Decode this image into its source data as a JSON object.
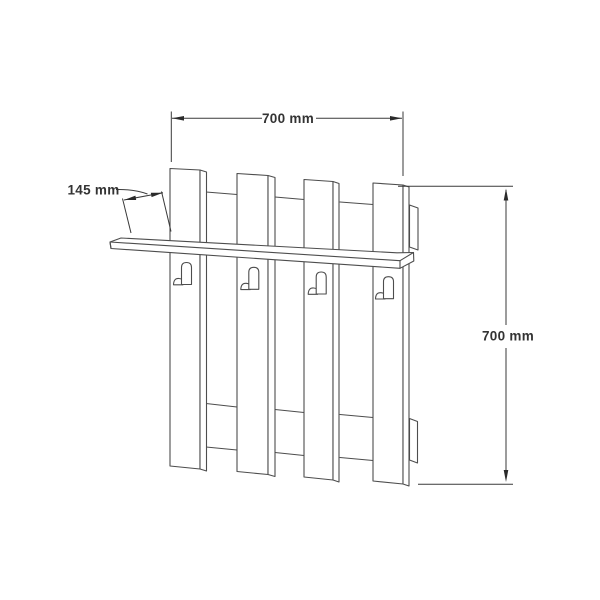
{
  "diagram": {
    "kind": "furniture dimension drawing",
    "subject": "wall-mounted coat rack with shelf and hooks",
    "components": {
      "planks": 4,
      "hooks": 4,
      "rails": 2,
      "shelves": 1
    }
  },
  "dimensions": {
    "width": {
      "label": "700 mm",
      "value": 700,
      "unit": "mm"
    },
    "height": {
      "label": "700 mm",
      "value": 700,
      "unit": "mm"
    },
    "depth": {
      "label": "145 mm",
      "value": 145,
      "unit": "mm"
    }
  },
  "colors": {
    "background": "#ffffff",
    "structure_line": "#4d4d4d",
    "dimension_line": "#3a3a3a",
    "text": "#333333"
  }
}
